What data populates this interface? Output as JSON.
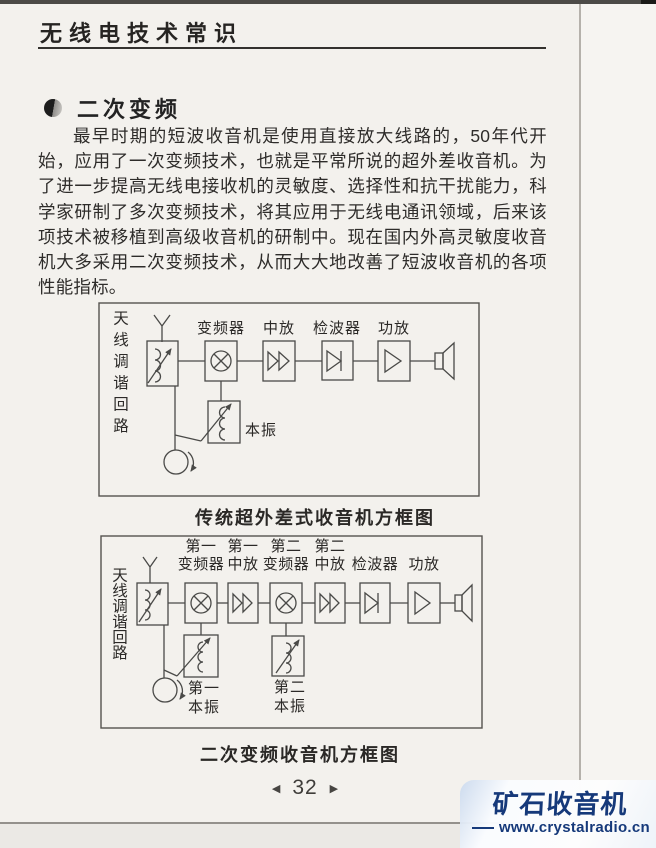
{
  "header": {
    "title": "无线电技术常识"
  },
  "section": {
    "title": "二次变频"
  },
  "body": {
    "paragraph": "最早时期的短波收音机是使用直接放大线路的，50年代开始，应用了一次变频技术，也就是平常所说的超外差收音机。为了进一步提高无线电接收机的灵敏度、选择性和抗干扰能力，科学家研制了多次变频技术，将其应用于无线电通讯领域，后来该项技术被移植到高级收音机的研制中。现在国内外高灵敏度收音机大多采用二次变频技术，从而大大地改善了短波收音机的各项性能指标。"
  },
  "figure1": {
    "caption": "传统超外差式收音机方框图",
    "antenna_tuning": "天线调谐回路",
    "mixer": "变频器",
    "if_amp": "中放",
    "detector": "检波器",
    "power_amp": "功放",
    "local_osc": "本振"
  },
  "figure2": {
    "caption": "二次变频收音机方框图",
    "antenna_tuning": "天线调谐回路",
    "mixer1_top": "第一",
    "mixer1_bottom": "变频器",
    "if1_top": "第一",
    "if1_bottom": "中放",
    "mixer2_top": "第二",
    "mixer2_bottom": "变频器",
    "if2_top": "第二",
    "if2_bottom": "中放",
    "detector": "检波器",
    "power_amp": "功放",
    "osc1_top": "第一",
    "osc1_bottom": "本振",
    "osc2_top": "第二",
    "osc2_bottom": "本振"
  },
  "footer": {
    "page_number": "32",
    "prev_glyph": "◀",
    "next_glyph": "▶"
  },
  "watermark": {
    "brand": "矿石收音机",
    "url": "www.crystalradio.cn",
    "brand_color": "#16397a"
  }
}
